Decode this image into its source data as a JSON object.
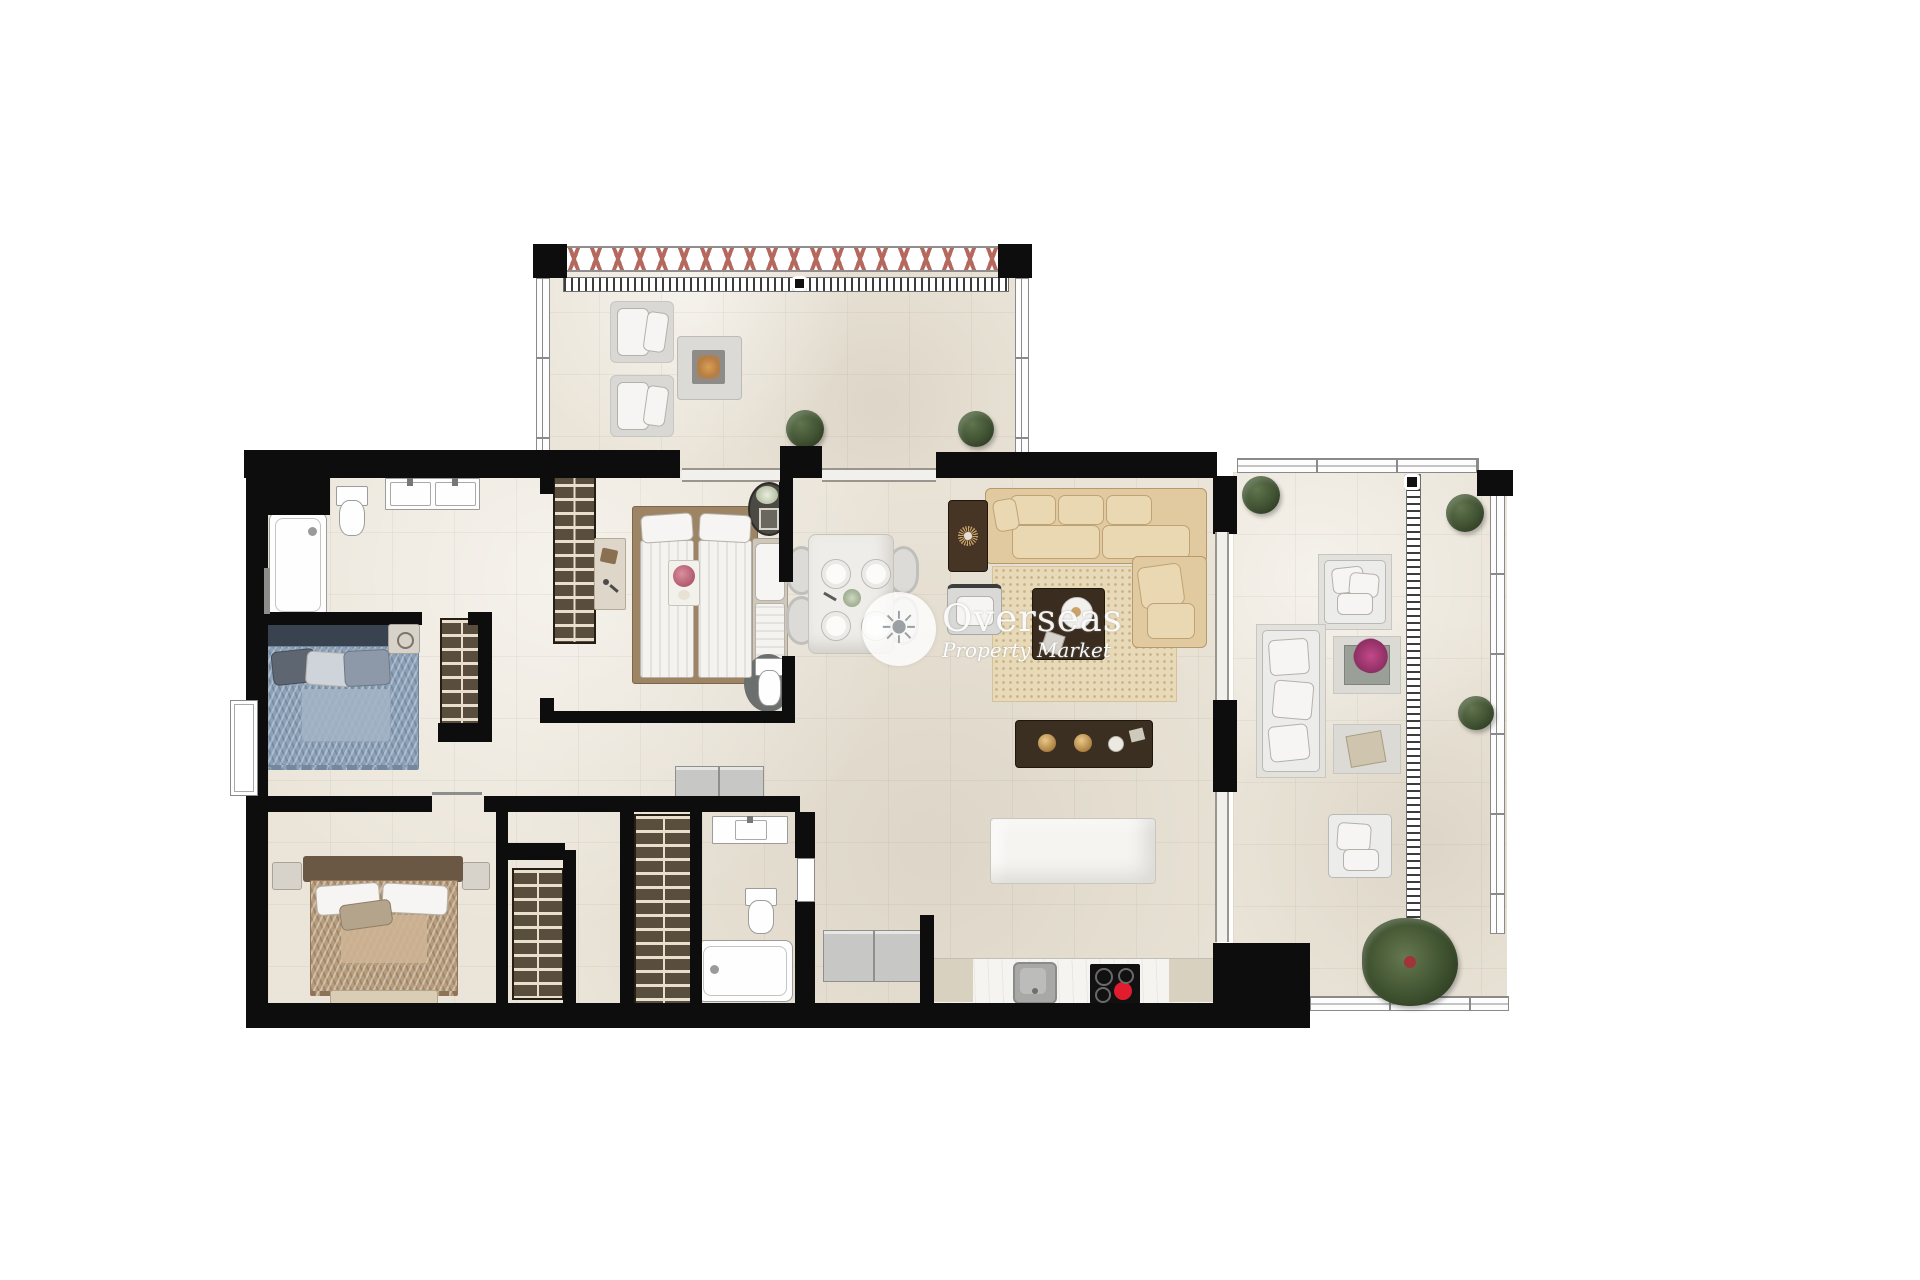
{
  "watermark": {
    "brand": "Overseas",
    "tagline": "Property Market",
    "logo_glyph": "☀",
    "logo": "sun-icon"
  },
  "palette": {
    "page_background": "#ffffff",
    "floor": "#ebe5d9",
    "wall": "#0d0d0d",
    "railing_baluster_x": "#b5695e",
    "wardrobe_wood": "#594d3d",
    "sofa_beige": "#e1ca9f",
    "rug_beige": "#e8dab8",
    "bed_blue_duvet": "#8ca1b8",
    "bed_tan_duvet": "#b79c7c",
    "dark_wood_furniture": "#3a2d1f",
    "plant_green": "#405232",
    "hob_black": "#111111",
    "hob_active_burner_red": "#e01c2e",
    "fire_table_glow": "#cf9454",
    "outdoor_furniture_white": "#ececea",
    "watermark_white": "rgba(255,255,255,0.9)"
  },
  "plan": {
    "type": "apartment-floor-plan-top-view",
    "rooms": [
      "top-terrace",
      "main-bathroom",
      "bedroom-blue",
      "bedroom-master",
      "ensuite-wc",
      "bedroom-bottom",
      "second-bathroom",
      "hallway",
      "dining-area",
      "living-room",
      "kitchen",
      "right-terrace"
    ],
    "furniture": [
      "sun-lounger",
      "sun-lounger",
      "fire-pit-table",
      "terrace-plant",
      "double-vanity",
      "toilet",
      "bathtub",
      "shower-tub",
      "double-bed-blue",
      "wardrobe",
      "double-bed-master",
      "daybed",
      "oval-plant-table",
      "dresser",
      "dining-table-marble",
      "dining-chair",
      "l-shaped-sofa",
      "coffee-table",
      "armchair",
      "console-sunburst",
      "area-rug",
      "kitchen-island-marble",
      "kitchen-island-dark-pendants",
      "kitchen-counter",
      "sink",
      "induction-hob",
      "fridge-units",
      "double-bed-tan",
      "bench",
      "outdoor-sofa",
      "outdoor-armchair",
      "outdoor-coffee-table",
      "outdoor-side-table",
      "palm-plant"
    ]
  }
}
